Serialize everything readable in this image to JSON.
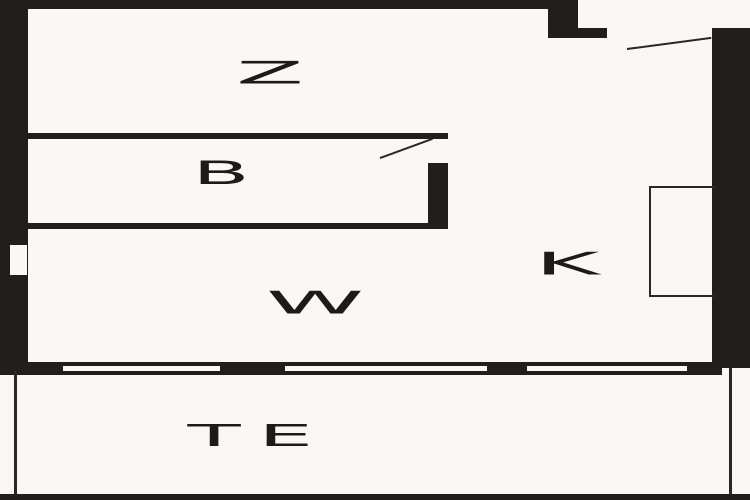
{
  "floorplan": {
    "rooms": {
      "z": {
        "label": "Z"
      },
      "b": {
        "label": "B"
      },
      "w": {
        "label": "W"
      },
      "k": {
        "label": "K"
      },
      "te": {
        "label": "TE"
      }
    },
    "colors": {
      "wall": "#221e1e",
      "line": "#2b2726",
      "bg": "#faf8f4"
    }
  }
}
